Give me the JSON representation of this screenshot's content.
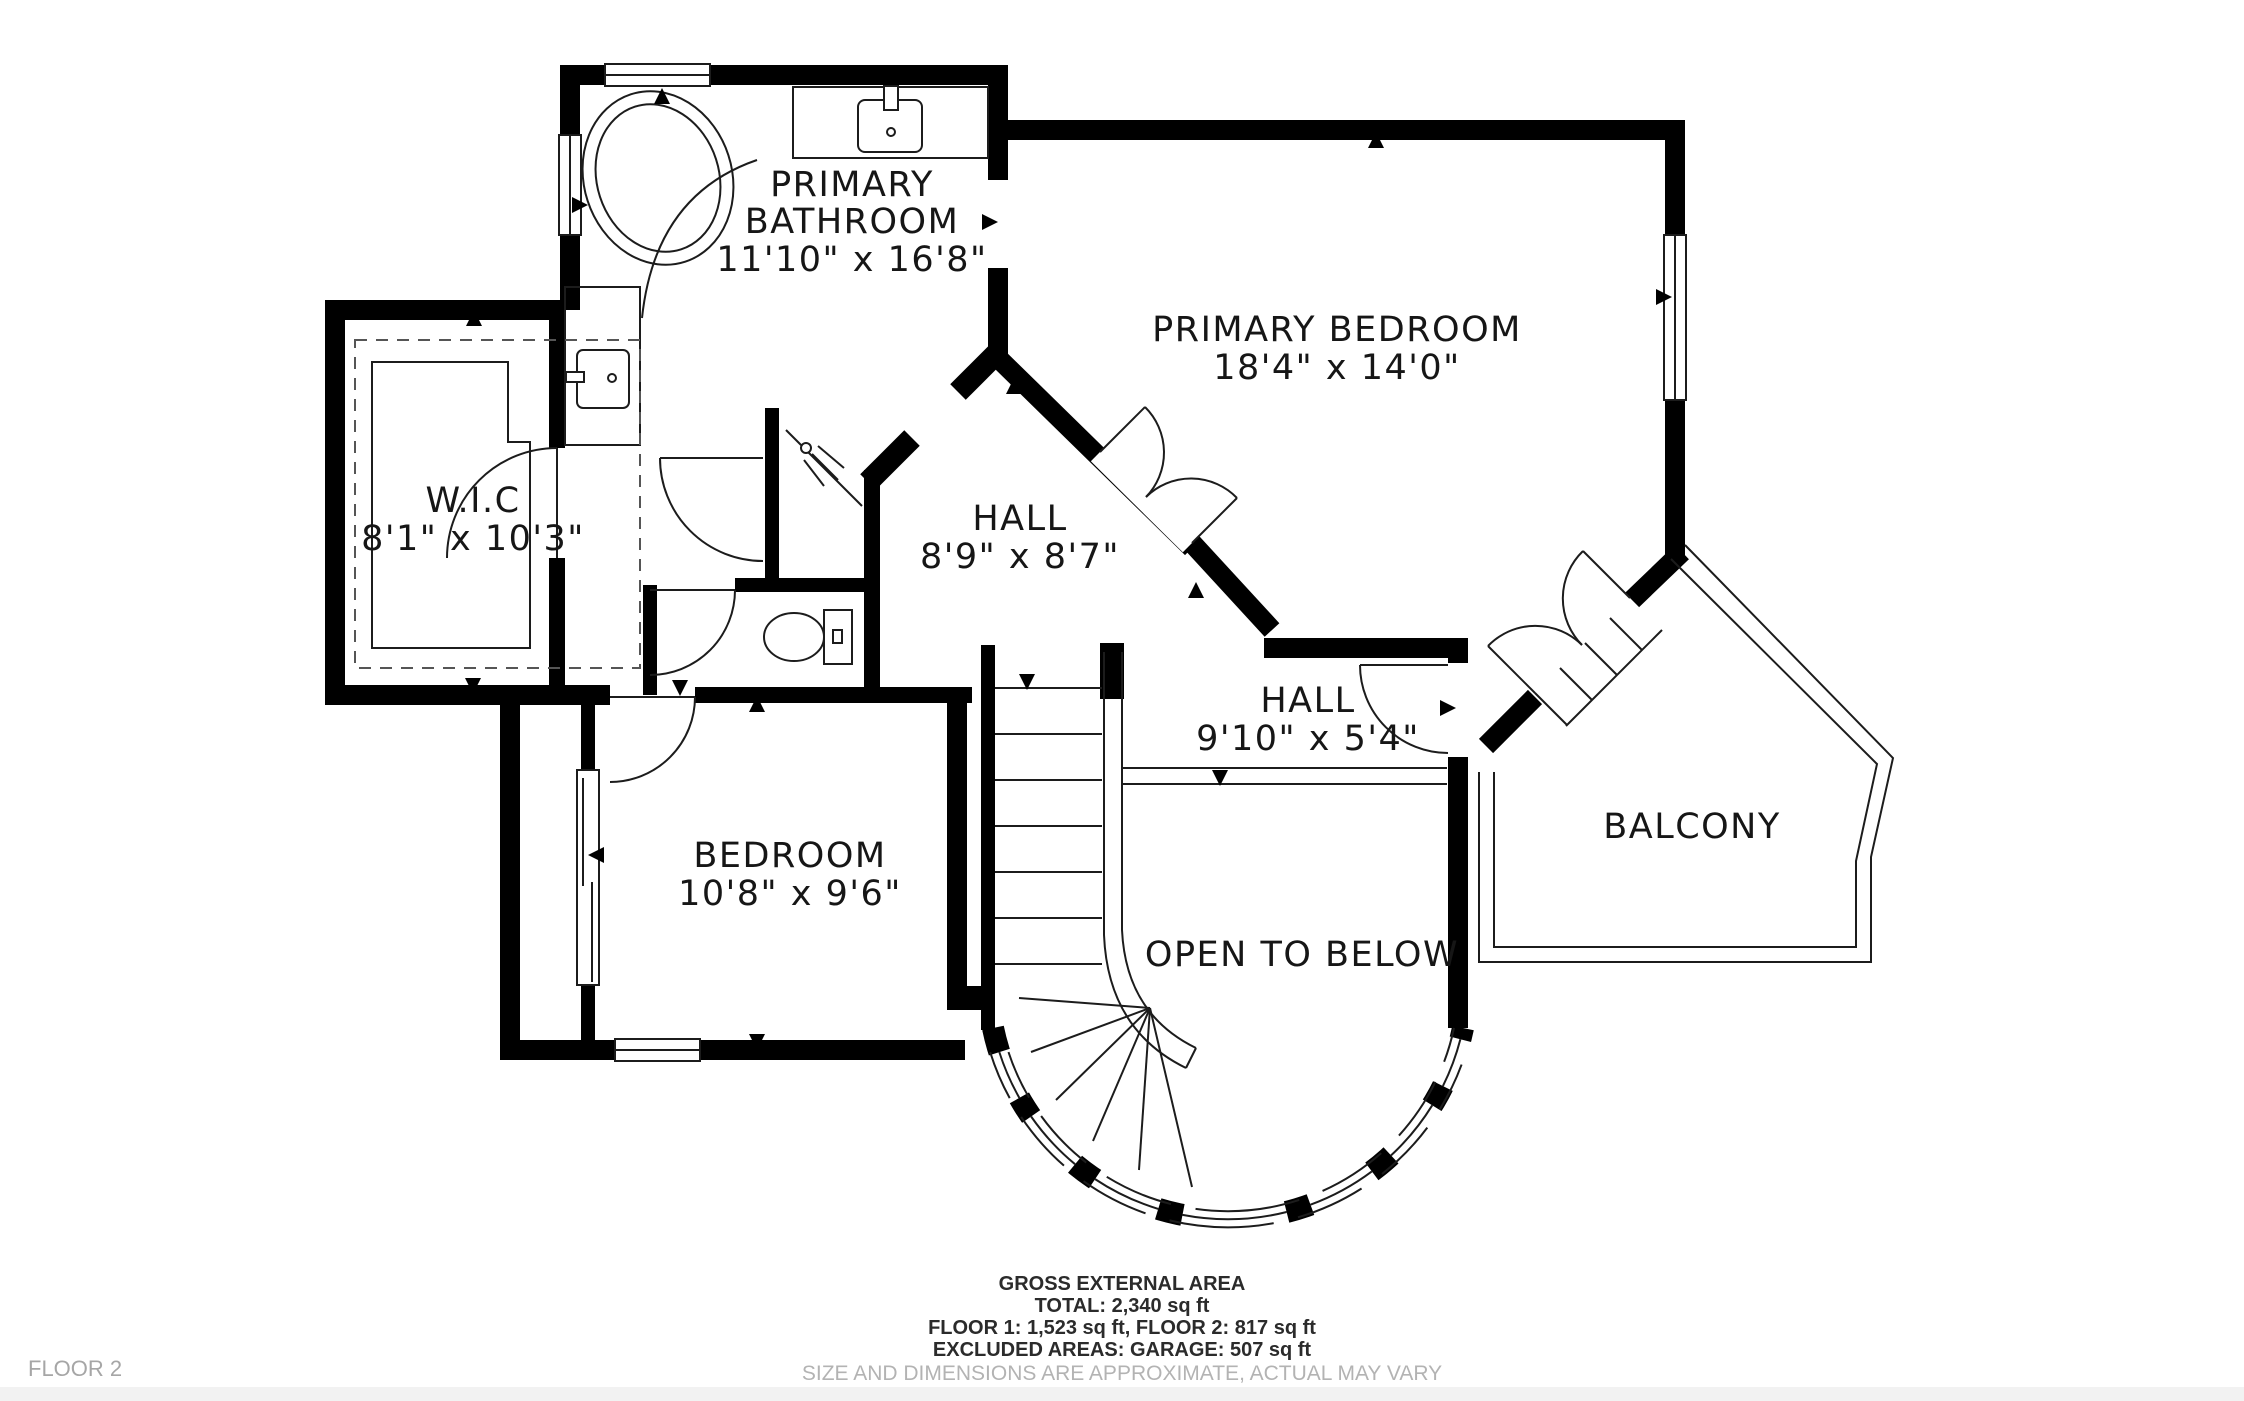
{
  "floor_label": "FLOOR 2",
  "rooms": {
    "primary_bathroom": {
      "label1": "PRIMARY",
      "label2": "BATHROOM",
      "dims": "11'10\" x 16'8\""
    },
    "primary_bedroom": {
      "label": "PRIMARY BEDROOM",
      "dims": "18'4\" x 14'0\""
    },
    "wic": {
      "label": "W.I.C",
      "dims": "8'1\" x 10'3\""
    },
    "hall_upper": {
      "label": "HALL",
      "dims": "8'9\" x 8'7\""
    },
    "hall_lower": {
      "label": "HALL",
      "dims": "9'10\" x 5'4\""
    },
    "bedroom": {
      "label": "BEDROOM",
      "dims": "10'8\" x 9'6\""
    },
    "balcony": {
      "label": "BALCONY"
    },
    "open_to_below": {
      "label": "OPEN TO BELOW"
    }
  },
  "footer": {
    "line1": "GROSS EXTERNAL AREA",
    "line2": "TOTAL: 2,340 sq ft",
    "line3": "FLOOR 1: 1,523 sq ft, FLOOR 2: 817 sq ft",
    "line4": "EXCLUDED AREAS: GARAGE: 507 sq ft",
    "disclaimer": "SIZE AND DIMENSIONS ARE APPROXIMATE, ACTUAL MAY VARY"
  },
  "colors": {
    "wall": "#000000",
    "line": "#1c1c1c",
    "text": "#161616",
    "muted_text": "#a6a6a6"
  }
}
